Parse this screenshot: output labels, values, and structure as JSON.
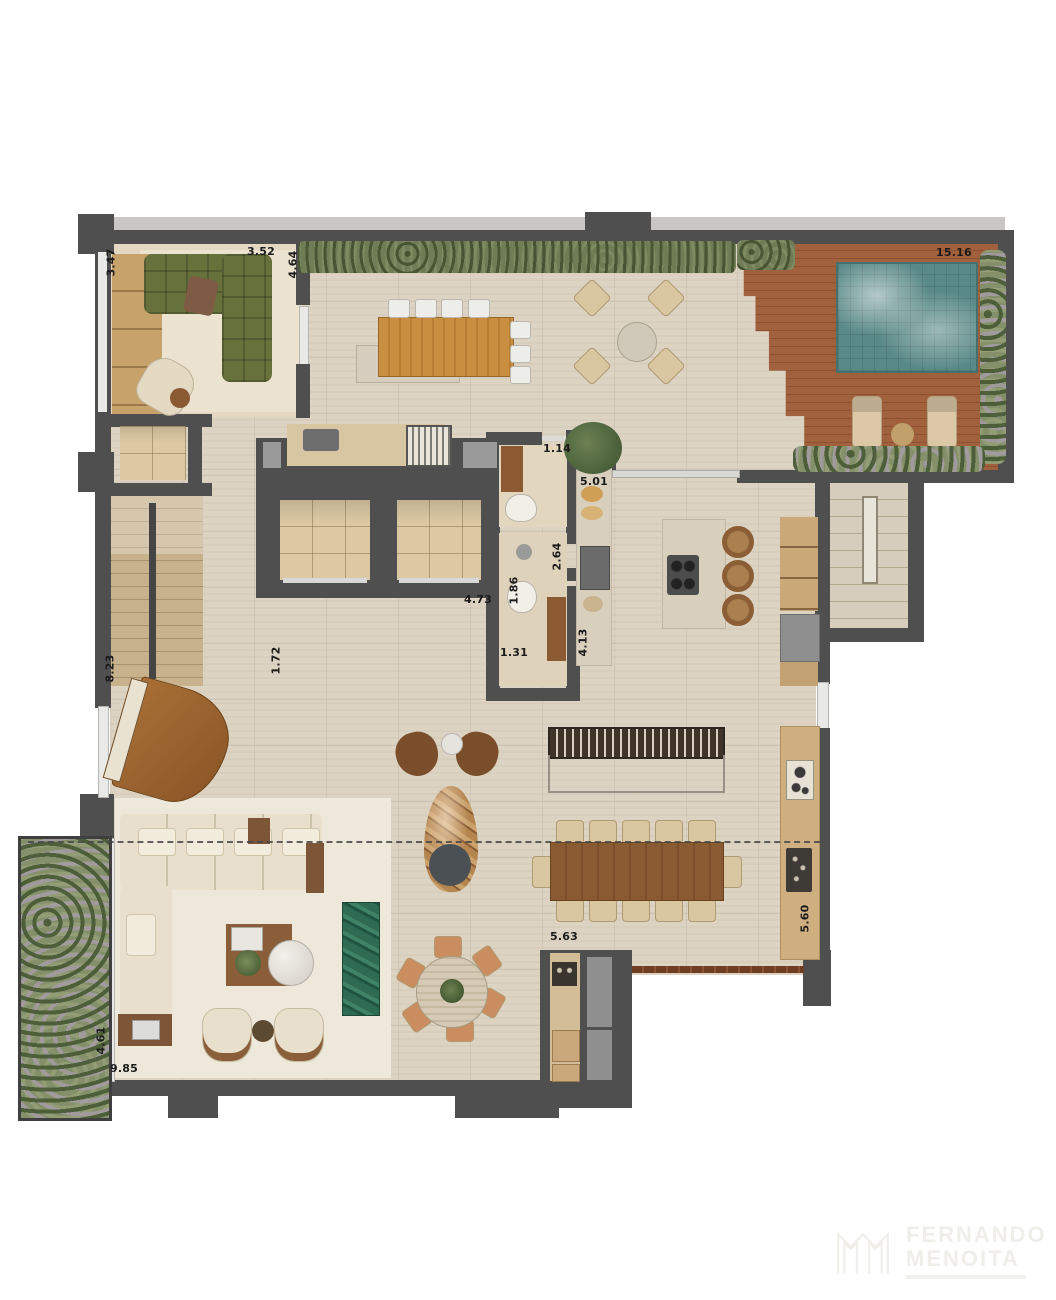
{
  "title": "penthouse-floor-plan-render",
  "dimensions": {
    "den_side": "3.47",
    "den_width": "3.52",
    "terrace_depth": "4.64",
    "deck_width": "15.16",
    "entry_door": "1.14",
    "counter_run": "5.01",
    "lavabo_depth": "2.64",
    "hall_width": "4.73",
    "wc_width": "1.86",
    "wc_niche": "1.31",
    "pantry_run": "4.13",
    "lift_hall": "1.72",
    "stair_wall": "8.23",
    "living_side": "4.61",
    "living_front": "9.85",
    "dining_span": "5.63",
    "gourmet_run": "5.60"
  },
  "watermark": {
    "name_line1": "FERNANDO",
    "name_line2": "MENOITA"
  },
  "colors": {
    "wall": "#4f4f50",
    "floor_travertine": "#ddd3c2",
    "deck_wood": "#a2613d",
    "pool_water": "#5a8a88",
    "hedge_green": "#6f7c55",
    "sofa_olive": "#67713c",
    "sofa_cream": "#e8e0cc",
    "wood_table": "#c98e3f",
    "wood_dark": "#8a5a33",
    "marble_green": "#2e6b52",
    "service_gray": "#8f8f8f"
  }
}
